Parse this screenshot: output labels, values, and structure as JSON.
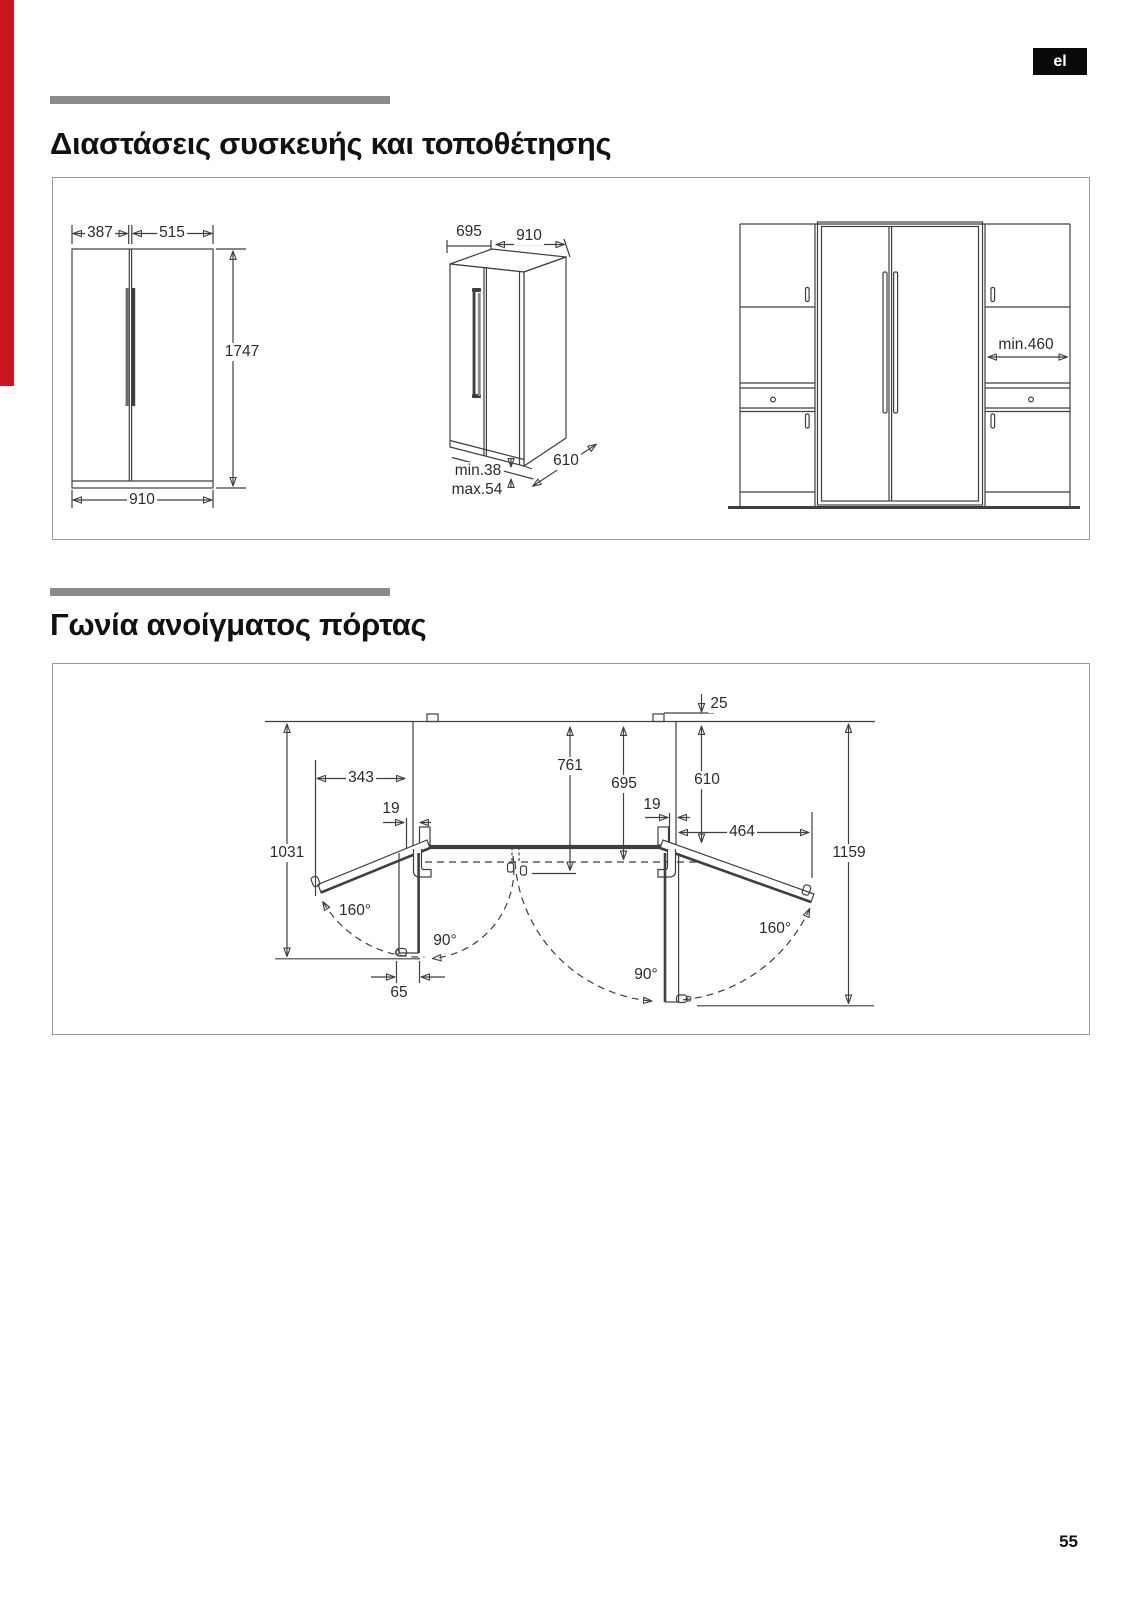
{
  "page": {
    "language_badge": "el",
    "page_number": "55",
    "accent_red": "#c7161d",
    "badge_bg": "#0a0a0a",
    "bar_gray": "#8a8a8a",
    "line_color": "#3f3f3f"
  },
  "section_dimensions": {
    "title": "Διαστάσεις συσκευής και τοποθέτησης",
    "front_view": {
      "door_left_width": "387",
      "door_right_width": "515",
      "height": "1747",
      "total_width": "910"
    },
    "perspective_view": {
      "depth": "695",
      "width": "910",
      "clearance_min": "min.38",
      "clearance_max": "max.54",
      "base_depth": "610"
    },
    "installation_view": {
      "side_clearance": "min.460"
    }
  },
  "section_door_angle": {
    "title": "Γωνία ανοίγματος πόρτας",
    "dimensions": {
      "rear_gap": "25",
      "depth_with_door": "761",
      "depth_with_hinge": "695",
      "body_depth": "610",
      "left_door_projection": "343",
      "left_hinge_offset": "19",
      "right_hinge_offset": "19",
      "right_door_projection": "464",
      "left_swing_depth": "1031",
      "right_swing_depth": "1159",
      "door_thickness": "65"
    },
    "angles": {
      "left_open": "160°",
      "left_perpendicular": "90°",
      "right_perpendicular": "90°",
      "right_open": "160°"
    }
  }
}
